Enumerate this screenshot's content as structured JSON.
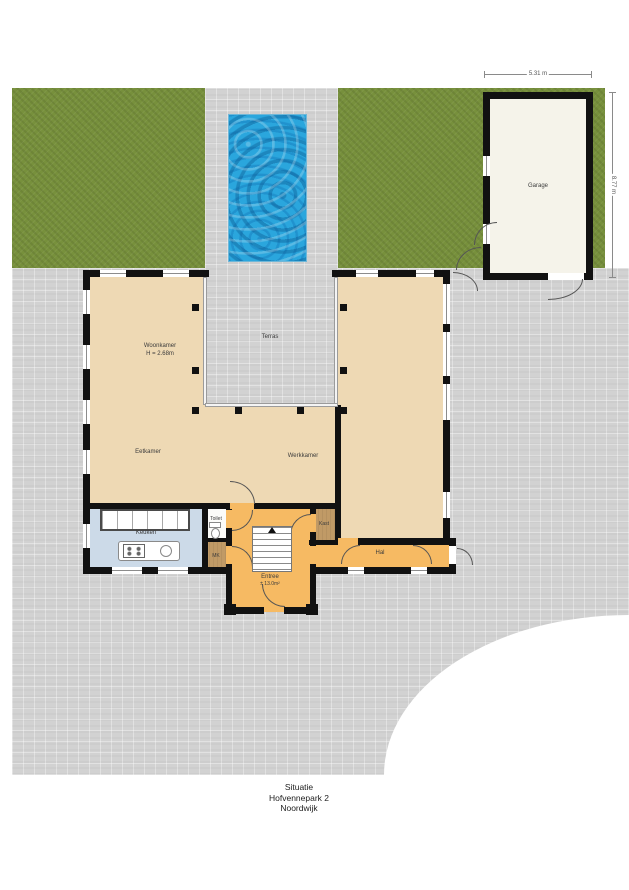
{
  "title": {
    "line1": "Situatie",
    "line2": "Hofvennepark 2",
    "line3": "Noordwijk"
  },
  "rooms": {
    "garage": "Garage",
    "woonkamer": "Woonkamer",
    "woonkamer_height": "H = 2.68m",
    "terras": "Terras",
    "eetkamer": "Eetkamer",
    "werkkamer": "Werkkamer",
    "keuken": "Keuken",
    "toilet": "Toilet",
    "meterkast": "MK",
    "entree": "Entree",
    "entree_area": "± 13.0m²",
    "kast": "Kast",
    "hal": "Hal"
  },
  "dimensions": {
    "garage_width": "5.31 m",
    "garage_depth": "8.77 m"
  },
  "colors": {
    "grass": "#77903c",
    "pavement": "#d2d2d2",
    "pool": "#2aa6dd",
    "room_tan": "#eed9b4",
    "room_orange": "#f6ba63",
    "room_kitchen": "#ccdae8",
    "room_brown": "#c09a66",
    "garage_floor": "#f5f3ea",
    "wall": "#111111"
  }
}
